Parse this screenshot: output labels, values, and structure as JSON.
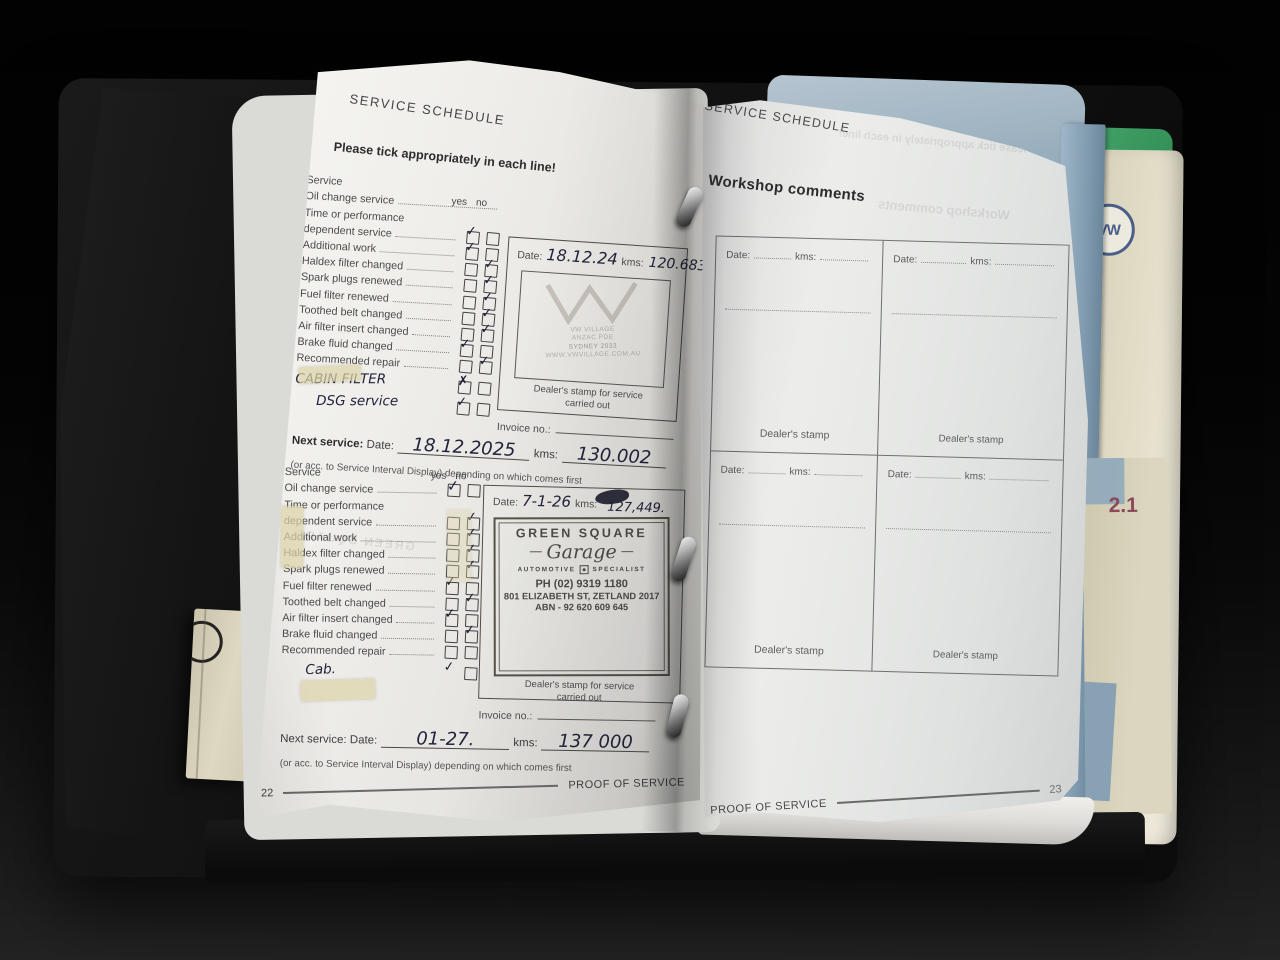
{
  "left_page": {
    "header": "SERVICE SCHEDULE",
    "instruction": "Please tick appropriately in each line!",
    "yes_label": "yes",
    "no_label": "no",
    "block1": {
      "rows": [
        {
          "label": "Service",
          "yes": "",
          "no": ""
        },
        {
          "label": "Oil change service",
          "yes": "",
          "no": ""
        },
        {
          "label": "Time or performance",
          "yes": "",
          "no": ""
        },
        {
          "label": "dependent service",
          "yes": "✓",
          "no": ""
        },
        {
          "label": "Additional work",
          "yes": "✓",
          "no": ""
        },
        {
          "label": "Haldex filter changed",
          "yes": "",
          "no": "✓"
        },
        {
          "label": "Spark plugs renewed",
          "yes": "",
          "no": "✓"
        },
        {
          "label": "Fuel filter renewed",
          "yes": "",
          "no": "✓"
        },
        {
          "label": "Toothed belt changed",
          "yes": "",
          "no": "✓"
        },
        {
          "label": "Air filter insert changed",
          "yes": "",
          "no": "✓"
        },
        {
          "label": "Brake fluid changed",
          "yes": "✓",
          "no": ""
        },
        {
          "label": "Recommended repair",
          "yes": "",
          "no": "✓"
        }
      ],
      "handwritten": [
        {
          "label": "CABIN FILTER",
          "tick": "✗"
        },
        {
          "label": "DSG service",
          "tick": "✓"
        }
      ],
      "date_label": "Date:",
      "date_value": "18.12.24",
      "kms_label": "kms:",
      "kms_value": "120.683",
      "stamp_lines": [
        "VW VILLAGE",
        "ANZAC PDE",
        "SYDNEY 2033",
        "WWW.VWVILLAGE.COM.AU"
      ],
      "stamp_caption": "Dealer's stamp for service",
      "stamp_caption2": "carried out",
      "invoice_label": "Invoice no.:",
      "next_label": "Next service:",
      "next_date_label": "Date:",
      "next_date_value": "18.12.2025",
      "next_kms_label": "kms:",
      "next_kms_value": "130.002",
      "footnote": "(or acc. to Service Interval Display) depending on which comes first"
    },
    "block2": {
      "rows": [
        {
          "label": "Service",
          "yes": "",
          "no": ""
        },
        {
          "label": "Oil change service",
          "yes": "✓",
          "no": ""
        },
        {
          "label": "Time or performance",
          "yes": "",
          "no": ""
        },
        {
          "label": "dependent service",
          "yes": "",
          "no": "✓"
        },
        {
          "label": "Additional work",
          "yes": "",
          "no": "✓"
        },
        {
          "label": "Haldex filter changed",
          "yes": "",
          "no": "✓"
        },
        {
          "label": "Spark plugs renewed",
          "yes": "",
          "no": "✓"
        },
        {
          "label": "Fuel filter renewed",
          "yes": "✓",
          "no": ""
        },
        {
          "label": "Toothed belt changed",
          "yes": "",
          "no": "✓"
        },
        {
          "label": "Air filter insert changed",
          "yes": "✓",
          "no": ""
        },
        {
          "label": "Brake fluid changed",
          "yes": "",
          "no": "✓"
        },
        {
          "label": "Recommended repair",
          "yes": "",
          "no": ""
        }
      ],
      "handwritten": [
        {
          "label": "Cab.",
          "tick": "✓"
        }
      ],
      "date_label": "Date:",
      "date_value": "7-1-26",
      "kms_label": "kms:",
      "kms_value": "127,449.",
      "stamp": {
        "name_top": "GREEN SQUARE",
        "name_script": "Garage",
        "tagline_left": "AUTOMOTIVE",
        "tagline_right": "SPECIALIST",
        "phone": "PH (02) 9319 1180",
        "address": "801 ELIZABETH ST, ZETLAND 2017",
        "abn": "ABN - 92 620 609 645"
      },
      "stamp_caption": "Dealer's stamp for service",
      "stamp_caption2": "carried out",
      "invoice_label": "Invoice no.:",
      "next_label": "Next service:",
      "next_date_label": "Date:",
      "next_date_value": "01-27.",
      "next_kms_label": "kms:",
      "next_kms_value": "137 000",
      "footnote": "(or acc. to Service Interval Display) depending on which comes first"
    },
    "page_number": "22",
    "footer": "PROOF OF SERVICE"
  },
  "right_page": {
    "header": "SERVICE SCHEDULE",
    "title": "Workshop comments",
    "date_label": "Date:",
    "kms_label": "kms:",
    "stamp_label": "Dealer's stamp",
    "footer": "PROOF OF SERVICE",
    "page_number": "23"
  },
  "spine_booklets": {
    "vw_badge": "VW",
    "section_number": "2.1"
  },
  "colors": {
    "green_booklet": "#3d9a61",
    "blue_booklet": "#8ba6bb",
    "cream_booklet": "#ded8c1",
    "maroon_label": "#8a4a57",
    "vw_blue": "#4a5f88",
    "ink": "#23233b",
    "paper": "#ecebe7"
  }
}
